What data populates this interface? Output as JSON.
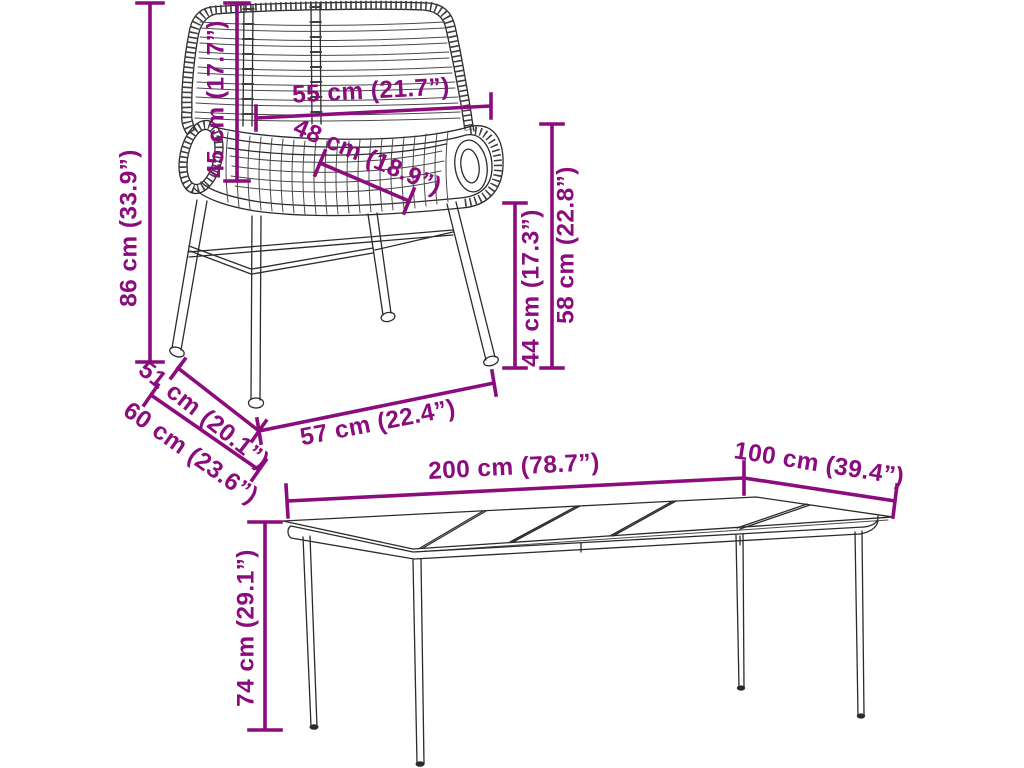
{
  "page": {
    "background": "#ffffff"
  },
  "style": {
    "dimension_color": "#8B0C7D",
    "line_art_color": "#2b2b2b"
  },
  "chair": {
    "item": "rattan dining chair line drawing",
    "dimensions": {
      "total_height": {
        "label": "86 cm (33.9”)",
        "cm": 86,
        "inches": 33.9
      },
      "backrest_height": {
        "label": "45 cm (17.7”)",
        "cm": 45,
        "inches": 17.7
      },
      "backrest_width": {
        "label": "55 cm (21.7”)",
        "cm": 55,
        "inches": 21.7
      },
      "seat_width": {
        "label": "48 cm (18.9”)",
        "cm": 48,
        "inches": 18.9
      },
      "seat_height": {
        "label": "44 cm (17.3”)",
        "cm": 44,
        "inches": 17.3
      },
      "armrest_height": {
        "label": "58 cm (22.8”)",
        "cm": 58,
        "inches": 22.8
      },
      "seat_depth": {
        "label": "51 cm (20.1”)",
        "cm": 51,
        "inches": 20.1
      },
      "total_depth": {
        "label": "60 cm (23.6”)",
        "cm": 60,
        "inches": 23.6
      },
      "front_width": {
        "label": "57 cm (22.4”)",
        "cm": 57,
        "inches": 22.4
      }
    }
  },
  "table": {
    "item": "garden dining table line drawing",
    "dimensions": {
      "length": {
        "label": "200 cm (78.7”)",
        "cm": 200,
        "inches": 78.7
      },
      "depth": {
        "label": "100 cm (39.4”)",
        "cm": 100,
        "inches": 39.4
      },
      "height": {
        "label": "74 cm (29.1”)",
        "cm": 74,
        "inches": 29.1
      }
    }
  }
}
